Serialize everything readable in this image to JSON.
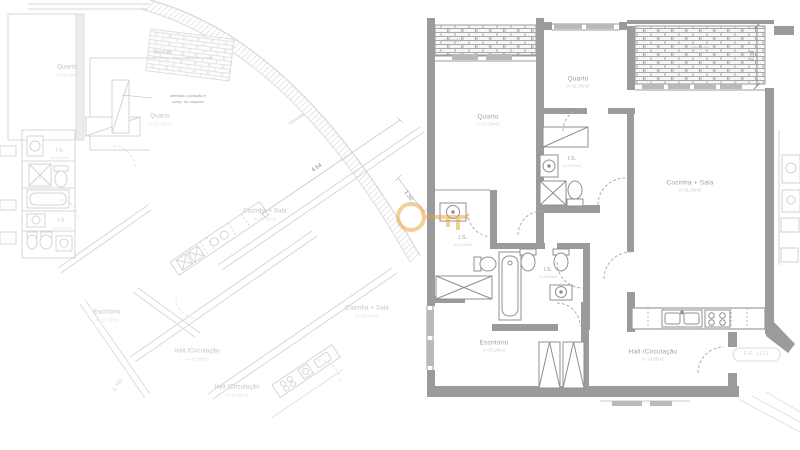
{
  "left_plan": {
    "rooms": {
      "quarto_tl": {
        "label": "Quarto",
        "area": "A=13.00m2"
      },
      "quarto_mid": {
        "label": "Quarto",
        "area": "A=11.20m2"
      },
      "varanda_top": {
        "label": "Varanda"
      },
      "varanda_arc": {
        "label": "Varanda"
      },
      "is_top": {
        "label": "I.S.",
        "area": "A=4.00m2"
      },
      "is_bottom": {
        "label": "I.S.",
        "area": "A=4.50m2"
      },
      "cozinha_upper": {
        "label": "Cozinha + Sala",
        "area": "A=31.80m2"
      },
      "cozinha_lower": {
        "label": "Cozinha + Sala",
        "area": "A=31.80m2"
      },
      "escritorio": {
        "label": "Escritório",
        "area": "A=10.25m2"
      },
      "hall_upper": {
        "label": "Hall /Circulação",
        "area": "A=10.00m2"
      },
      "hall_lower": {
        "label": "Hall /Circulação",
        "area": "A=10.00m2"
      },
      "zona_tecnica": {
        "label": "Z. Téc."
      }
    },
    "annotation": {
      "line1": "alterada a posição e",
      "line2": "comp. do roupeiro"
    },
    "dimensions": {
      "d464": "4.64",
      "d130": "1.30"
    }
  },
  "right_plan": {
    "rooms": {
      "varanda_left": {
        "label": "Varanda"
      },
      "varanda_right": {
        "label": "Varanda"
      },
      "quarto_left": {
        "label": "Quarto",
        "area": "A=13.10m2"
      },
      "quarto_top": {
        "label": "Quarto",
        "area": "A=11.05m2"
      },
      "cozinha_sala": {
        "label": "Cozinha + Sala",
        "area": "A=31.80m2"
      },
      "escritorio": {
        "label": "Escritório",
        "area": "A=10.25m2"
      },
      "hall": {
        "label": "Hall /Circulação",
        "area": "A=10.85m2"
      },
      "is_1": {
        "label": "I.S.",
        "area": "A=4.00m2"
      },
      "is_ensuite": {
        "label": "I.S.",
        "area": "A=4.25m2"
      },
      "is_2": {
        "label": "I.S.",
        "area": "A=4.50m2"
      }
    },
    "dimensions": {
      "d208": "2.08"
    },
    "unit_tag": "F.E. (12)"
  },
  "watermark": {
    "icon": "key",
    "color": "#E8A13B"
  }
}
